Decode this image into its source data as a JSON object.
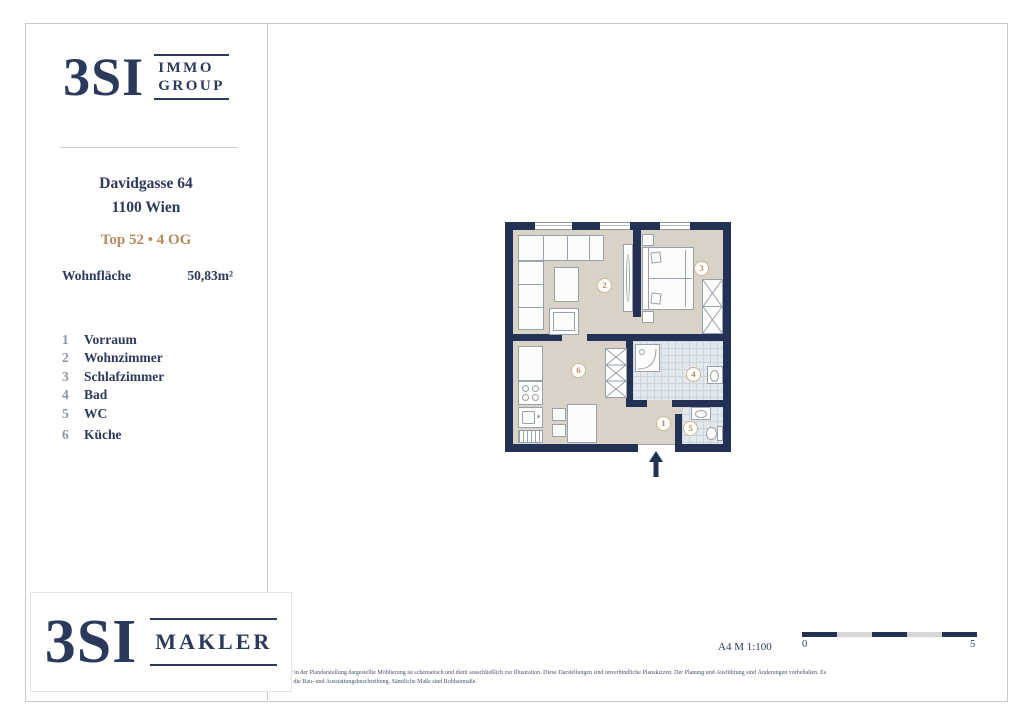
{
  "colors": {
    "navy": "#2b3a5c",
    "tan_accent": "#b98a5e",
    "wall": "#233154",
    "floor_beige": "#d9d3c7",
    "tile_blue": "#e3e8ec"
  },
  "sidebar": {
    "logo": {
      "brand": "3SI",
      "sub_top": "IMMO",
      "sub_bottom": "GROUP"
    },
    "address_line1": "Davidgasse 64",
    "address_line2": "1100 Wien",
    "unit_line": "Top 52 • 4 OG",
    "area_label": "Wohnfläche",
    "area_value": "50,83m²",
    "legend": [
      {
        "num": "1",
        "label": "Vorraum"
      },
      {
        "num": "2",
        "label": "Wohnzimmer"
      },
      {
        "num": "3",
        "label": "Schlafzimmer"
      },
      {
        "num": "4",
        "label": "Bad"
      },
      {
        "num": "5",
        "label": "WC"
      },
      {
        "num": "6",
        "label": "Küche"
      }
    ]
  },
  "plan": {
    "room_numbers": {
      "vorraum": "1",
      "wohnzimmer": "2",
      "schlafzimmer": "3",
      "bad": "4",
      "wc": "5",
      "kueche": "6"
    }
  },
  "footer": {
    "format_scale": "A4  M 1:100",
    "scale_start": "0",
    "scale_end": "5",
    "disclaimer_line1": "Die in der Plandarstellung dargestellte Möblierung ist schematisch und dient ausschließlich zur Illustration. Diese Darstellungen sind unverbindliche Planskizzen. Der Planung und Ausführung sind Änderungen vorbehalten. Es",
    "disclaimer_line2": "gilt die Bau- und Ausstattungsbeschreibung. Sämtliche Maße sind Rohbaumaße."
  },
  "footer_logo": {
    "brand": "3SI",
    "sub": "MAKLER"
  }
}
